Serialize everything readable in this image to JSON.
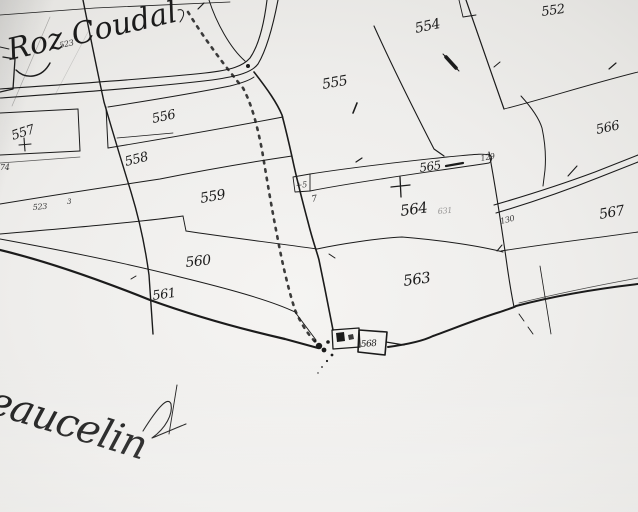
{
  "map": {
    "kind": "hand-drawn cadastral plan (scanned photograph)",
    "region_title": "Roz Coudal",
    "bottom_annotation": "eaucelin",
    "parcel_labels": {
      "p552": "552",
      "p554": "554",
      "p555": "555",
      "p556": "556",
      "p557": "557",
      "p558": "558",
      "p559": "559",
      "p560": "560",
      "p561": "561",
      "p563": "563",
      "p564": "564",
      "p565": "565",
      "p566": "566",
      "p567": "567",
      "p568": "568"
    },
    "small_numbers": {
      "under_title": "523",
      "left_sliver": "74",
      "left_low": "523",
      "left_tiny": "3",
      "wedge_plus": "+5",
      "wedge_seven": "7",
      "strip_end": "129",
      "mid_boundary": "130",
      "faint_note": "631"
    },
    "colors": {
      "ink": "#1b1b1b",
      "paper": "#e8e7e5"
    }
  }
}
